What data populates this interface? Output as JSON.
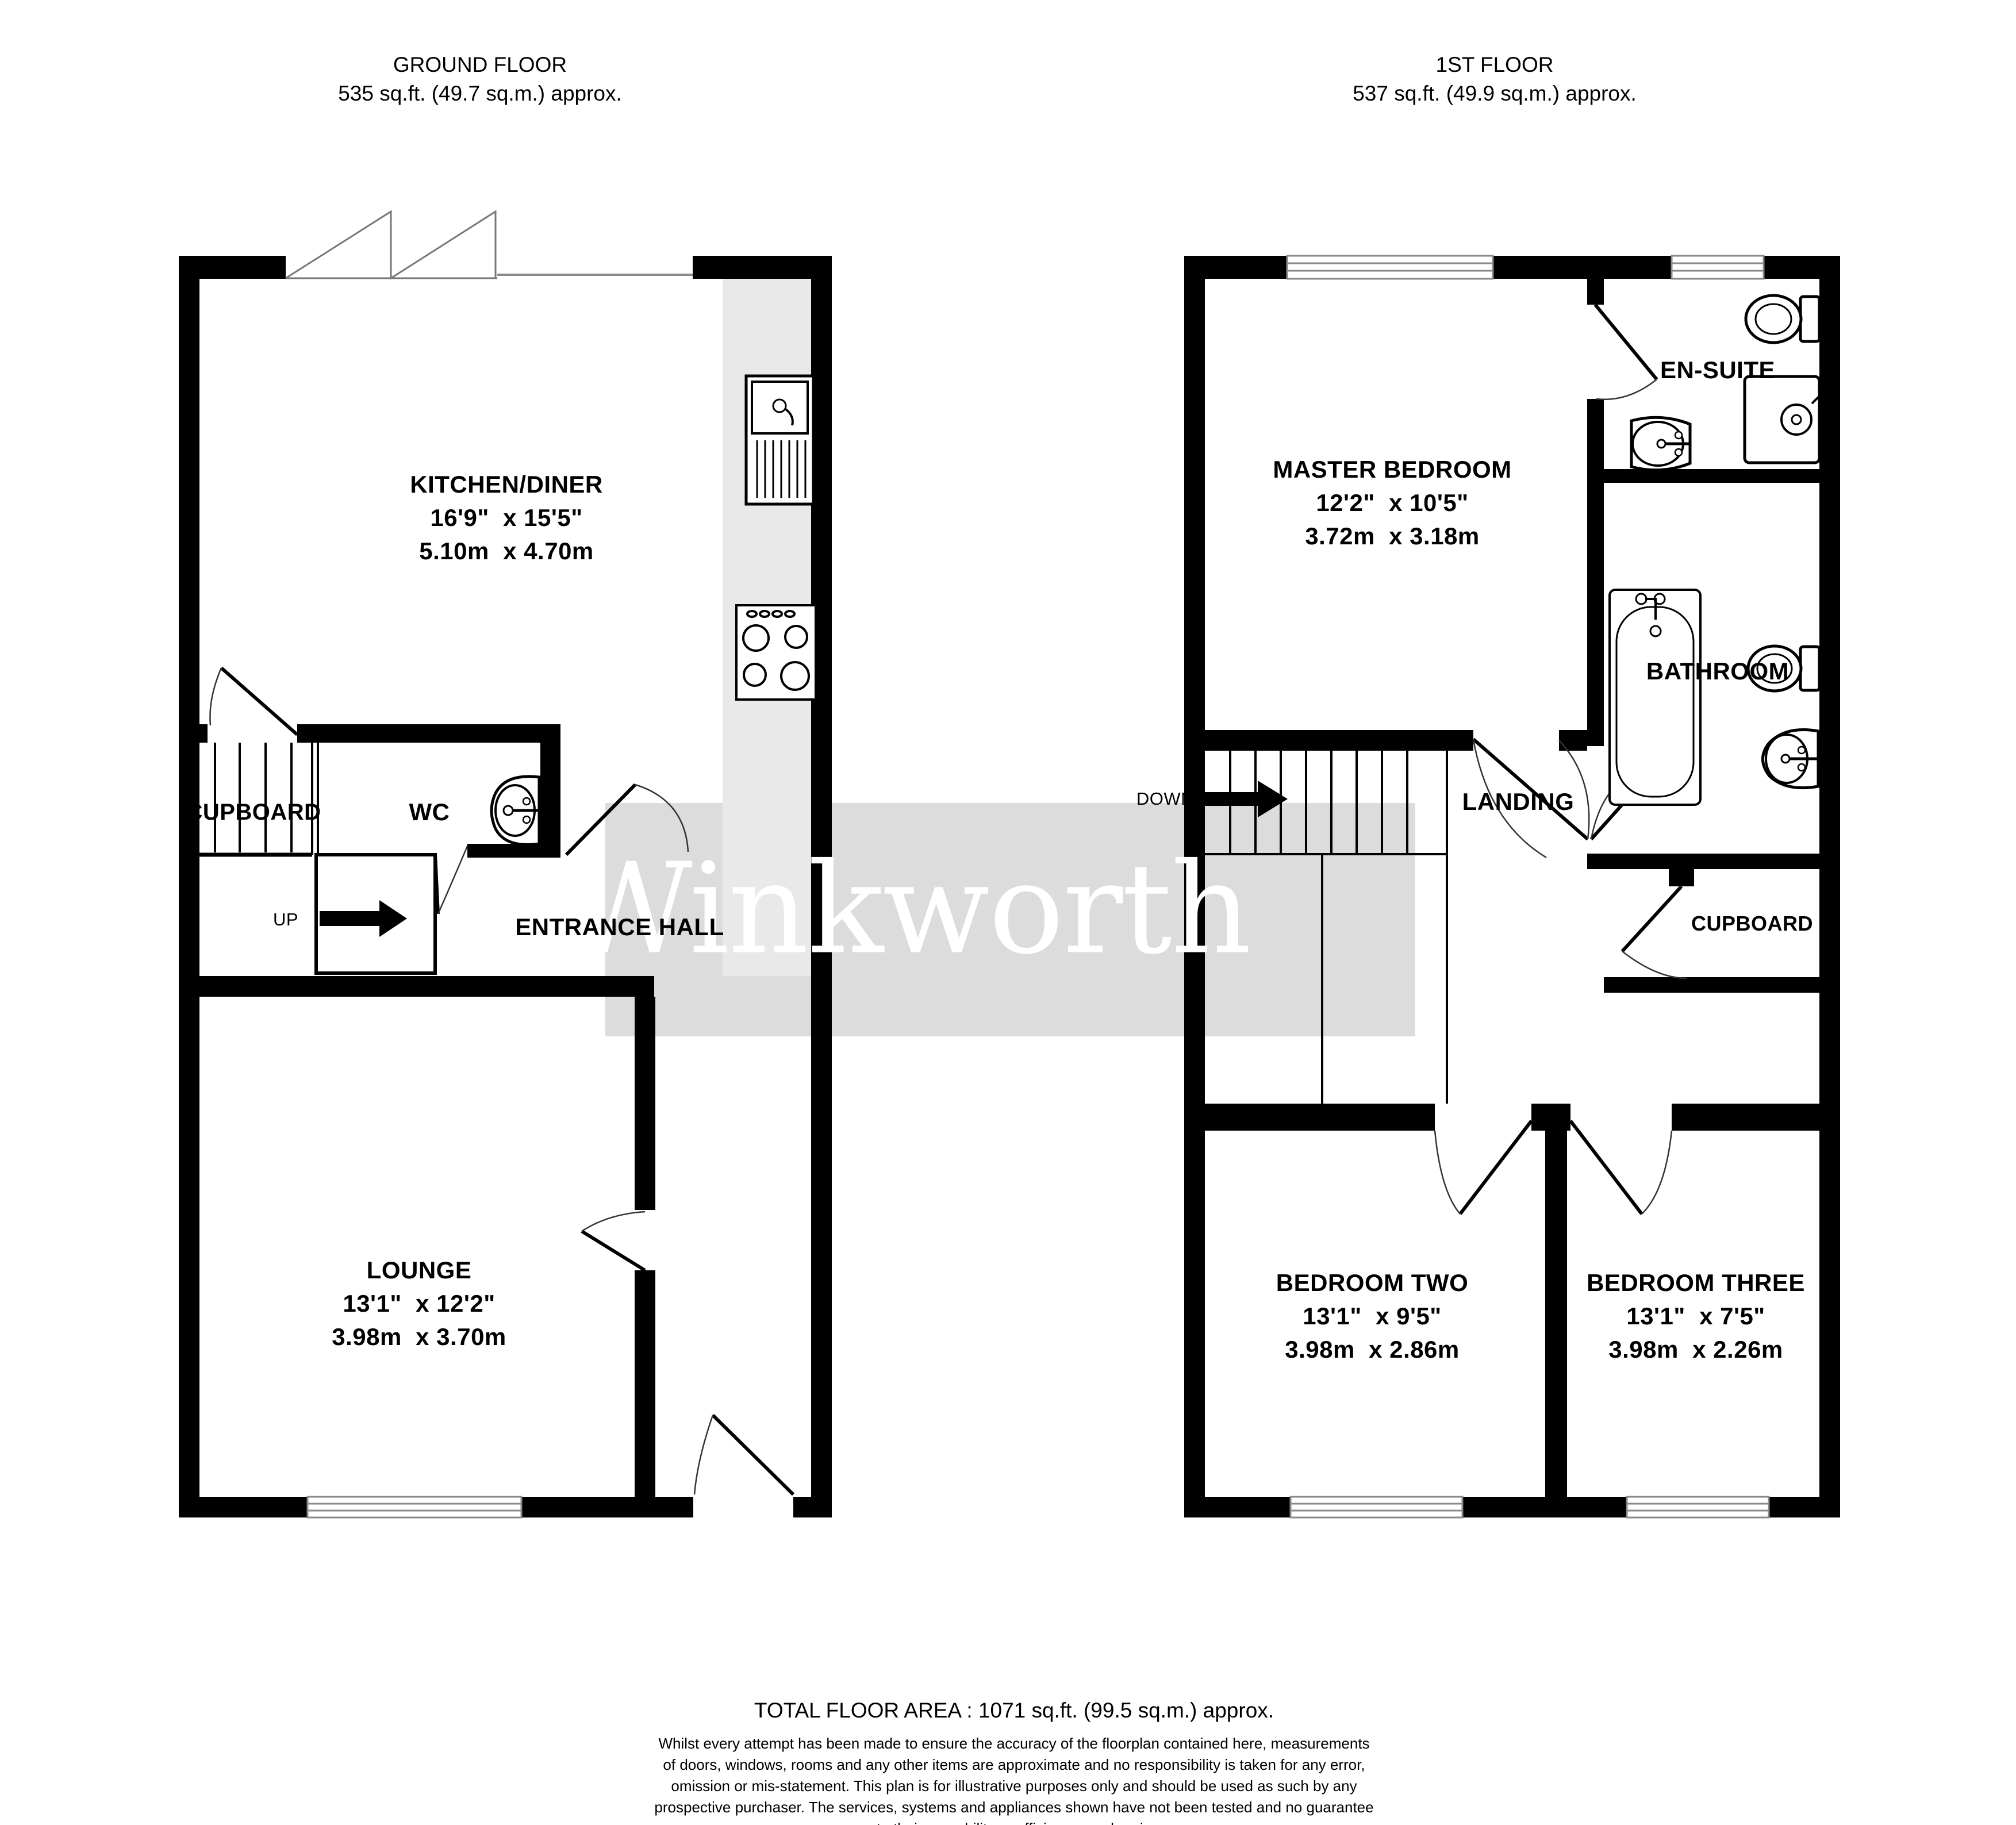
{
  "headers": {
    "ground": {
      "name": "GROUND FLOOR",
      "area": "535 sq.ft. (49.7 sq.m.) approx."
    },
    "first": {
      "name": "1ST FLOOR",
      "area": "537 sq.ft. (49.9 sq.m.) approx."
    }
  },
  "watermark": {
    "text": "Winkworth"
  },
  "rooms": {
    "kitchen": {
      "label": "KITCHEN/DINER",
      "imperial": "16'9\"  x 15'5\"",
      "metric": "5.10m  x 4.70m"
    },
    "lounge": {
      "label": "LOUNGE",
      "imperial": "13'1\"  x 12'2\"",
      "metric": "3.98m  x 3.70m"
    },
    "entrance": {
      "label": "ENTRANCE HALL"
    },
    "wc": {
      "label": "WC"
    },
    "cupboard_gf": {
      "label": "CUPBOARD"
    },
    "master": {
      "label": "MASTER BEDROOM",
      "imperial": "12'2\"  x 10'5\"",
      "metric": "3.72m  x 3.18m"
    },
    "ensuite": {
      "label": "EN-SUITE"
    },
    "bathroom": {
      "label": "BATHROOM"
    },
    "landing": {
      "label": "LANDING"
    },
    "cupboard_ff": {
      "label": "CUPBOARD"
    },
    "bed2": {
      "label": "BEDROOM TWO",
      "imperial": "13'1\"  x 9'5\"",
      "metric": "3.98m  x 2.86m"
    },
    "bed3": {
      "label": "BEDROOM THREE",
      "imperial": "13'1\"  x 7'5\"",
      "metric": "3.98m  x 2.26m"
    }
  },
  "annotations": {
    "up": "UP",
    "down": "DOWN"
  },
  "footer": {
    "total": "TOTAL FLOOR AREA : 1071 sq.ft. (99.5 sq.m.) approx.",
    "disclaimer": "Whilst every attempt has been made to ensure the accuracy of the floorplan contained here, measurements\nof doors, windows, rooms and any other items are approximate and no responsibility is taken for any error,\nomission or mis-statement. This plan is for illustrative purposes only and should be used as such by any\nprospective purchaser. The services, systems and appliances shown have not been tested and no guarantee\nas to their operability or efficiency can be given.\nMade with Metropix ©2023"
  },
  "colors": {
    "wall": "#000000",
    "watermark_band": "#dcdcdc",
    "counter": "#e9e9e9",
    "window_line": "#8a8a8a"
  }
}
